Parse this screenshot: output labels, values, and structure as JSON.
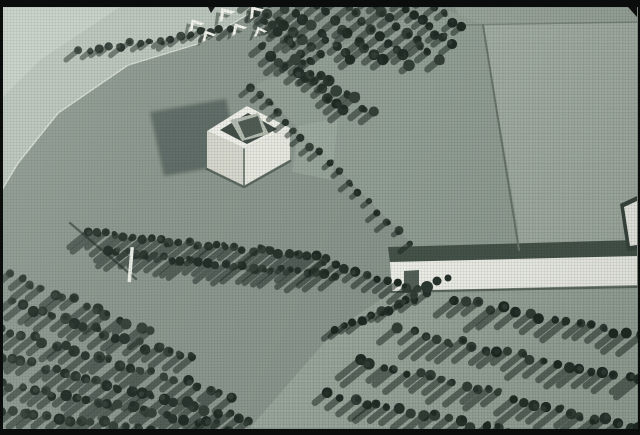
{
  "canvas": {
    "w": 640,
    "h": 435
  },
  "palette": {
    "lawn": "#8b978e",
    "light_wedge": "#bac5bb",
    "light_wedge_corner": "#cdd5ca",
    "plateau": "#a3aea4",
    "center_field": "#93a096",
    "south_field": "#9aa69c",
    "pale_patch": "#a4b0a5",
    "hedge_band": "#46544b",
    "white_structure": "#f2f3ec",
    "tree_dark_1": "#26322b",
    "tree_dark_2": "#323f37",
    "tree_dark_3": "#1f2a24",
    "tree_shadow": "rgba(22,34,27,0.5)",
    "film_border": "#0b0d0c"
  },
  "polygons": [
    {
      "name": "roadside-light-wedge",
      "points": [
        [
          0,
          7
        ],
        [
          258,
          7
        ],
        [
          200,
          42
        ],
        [
          128,
          64
        ],
        [
          58,
          112
        ],
        [
          18,
          162
        ],
        [
          0,
          192
        ]
      ],
      "fill": "#bac5bb"
    },
    {
      "name": "roadside-light-corner",
      "points": [
        [
          0,
          7
        ],
        [
          120,
          7
        ],
        [
          40,
          60
        ],
        [
          0,
          100
        ]
      ],
      "fill": "#cdd5ca",
      "opacity": 0.7
    },
    {
      "name": "upper-road-band",
      "points": [
        [
          455,
          7
        ],
        [
          637,
          7
        ],
        [
          637,
          23
        ],
        [
          462,
          25
        ]
      ],
      "fill": "#99a49a"
    },
    {
      "name": "gravel-plateau-field",
      "points": [
        [
          483,
          25
        ],
        [
          637,
          23
        ],
        [
          637,
          248
        ],
        [
          520,
          251
        ],
        [
          505,
          158
        ]
      ],
      "fill": "#a3aea4",
      "speckle": true
    },
    {
      "name": "center-meadow",
      "points": [
        [
          255,
          85
        ],
        [
          435,
          5
        ],
        [
          483,
          25
        ],
        [
          517,
          222
        ],
        [
          520,
          252
        ],
        [
          394,
          261
        ],
        [
          408,
          240
        ]
      ],
      "fill": "#93a096"
    },
    {
      "name": "pale-ground-patch",
      "points": [
        [
          298,
          126
        ],
        [
          338,
          118
        ],
        [
          332,
          180
        ],
        [
          292,
          172
        ]
      ],
      "fill": "#a4b0a5",
      "opacity": 0.55
    },
    {
      "name": "south-field",
      "points": [
        [
          392,
          292
        ],
        [
          637,
          286
        ],
        [
          637,
          428
        ],
        [
          250,
          428
        ],
        [
          335,
          330
        ]
      ],
      "fill": "#9aa69c",
      "speckle": true
    },
    {
      "name": "cube-cast-shadow",
      "points": [
        [
          150,
          112
        ],
        [
          226,
          99
        ],
        [
          240,
          163
        ],
        [
          164,
          176
        ]
      ],
      "fill": "rgba(28,42,34,0.40)",
      "blur": true
    },
    {
      "name": "hedge-band-behind-wall",
      "points": [
        [
          388,
          247
        ],
        [
          637,
          240
        ],
        [
          637,
          259
        ],
        [
          390,
          263
        ]
      ],
      "fill": "#46544b"
    },
    {
      "name": "long-white-wall",
      "points": [
        [
          390,
          262
        ],
        [
          637,
          256
        ],
        [
          637,
          285
        ],
        [
          392,
          291
        ]
      ],
      "fill": "#f2f3ec"
    },
    {
      "name": "wall-left-notch",
      "points": [
        [
          404,
          271
        ],
        [
          419,
          270
        ],
        [
          419,
          291
        ],
        [
          404,
          292
        ]
      ],
      "fill": "#55625a"
    },
    {
      "name": "edge-structure-frame",
      "points": [
        [
          620,
          204
        ],
        [
          637,
          196
        ],
        [
          637,
          250
        ],
        [
          627,
          251
        ]
      ],
      "fill": "#39453e"
    },
    {
      "name": "edge-structure-roof",
      "points": [
        [
          624,
          207
        ],
        [
          637,
          201
        ],
        [
          637,
          245
        ],
        [
          630,
          246
        ]
      ],
      "fill": "#eff0e9"
    },
    {
      "name": "cube-face-left",
      "points": [
        [
          207,
          131
        ],
        [
          244,
          148
        ],
        [
          244,
          186
        ],
        [
          207,
          168
        ]
      ],
      "fill": "#d8d9cf"
    },
    {
      "name": "cube-face-right",
      "points": [
        [
          244,
          148
        ],
        [
          290,
          128
        ],
        [
          290,
          160
        ],
        [
          244,
          186
        ]
      ],
      "fill": "#e9eae1"
    },
    {
      "name": "cube-roof-rim",
      "points": [
        [
          207,
          131
        ],
        [
          247,
          106
        ],
        [
          290,
          128
        ],
        [
          244,
          148
        ]
      ],
      "fill": "#f1f2ea"
    },
    {
      "name": "cube-courtyard-opening",
      "points": [
        [
          220,
          130
        ],
        [
          248,
          113
        ],
        [
          277,
          129
        ],
        [
          247,
          144
        ]
      ],
      "fill": "#3e4943"
    },
    {
      "name": "cube-inner-tilted-plane",
      "points": [
        [
          230,
          120
        ],
        [
          258,
          113
        ],
        [
          269,
          134
        ],
        [
          242,
          141
        ]
      ],
      "fill": "#b5bcb0"
    },
    {
      "name": "cube-inner-core",
      "points": [
        [
          238,
          122
        ],
        [
          258,
          116
        ],
        [
          263,
          132
        ],
        [
          245,
          138
        ]
      ],
      "fill": "#4d5850"
    },
    {
      "name": "film-notch-top",
      "points": [
        [
          208,
          7
        ],
        [
          215,
          7
        ],
        [
          211,
          13
        ]
      ],
      "fill": "#0d0f0e"
    },
    {
      "name": "film-notch-top-right",
      "points": [
        [
          628,
          7
        ],
        [
          637,
          7
        ],
        [
          637,
          17
        ]
      ],
      "fill": "#0d0f0e"
    }
  ],
  "polylines": [
    {
      "name": "path-edge-line",
      "points": [
        [
          258,
          8
        ],
        [
          200,
          43
        ],
        [
          128,
          65
        ],
        [
          58,
          113
        ],
        [
          18,
          163
        ],
        [
          0,
          193
        ]
      ],
      "stroke": "#d6ddd3",
      "width": 1.6
    },
    {
      "name": "cube-base-shadow",
      "points": [
        [
          207,
          169
        ],
        [
          244,
          187
        ],
        [
          290,
          161
        ]
      ],
      "stroke": "rgba(25,38,31,0.45)",
      "width": 2.5
    }
  ],
  "lines": [
    {
      "name": "plateau-top-edge",
      "x1": 458,
      "y1": 25,
      "x2": 637,
      "y2": 22,
      "stroke": "#7b867d",
      "width": 1.5
    },
    {
      "name": "plateau-left-edge",
      "x1": 483,
      "y1": 25,
      "x2": 519,
      "y2": 250,
      "stroke": "#6b766d",
      "width": 2
    },
    {
      "name": "pole-shadow-line",
      "x1": 70,
      "y1": 223,
      "x2": 136,
      "y2": 279,
      "stroke": "rgba(26,39,32,0.55)",
      "width": 2.4
    },
    {
      "name": "wall-bottom-shadow",
      "x1": 392,
      "y1": 292,
      "x2": 637,
      "y2": 287,
      "stroke": "rgba(30,42,35,0.5)",
      "width": 2
    },
    {
      "name": "cube-split-seam",
      "x1": 244,
      "y1": 149,
      "x2": 244,
      "y2": 185,
      "stroke": "#6f7a71",
      "width": 1.8
    }
  ],
  "trees": {
    "fills": [
      "#26322b",
      "#323f37",
      "#1f2a24"
    ],
    "shadow": "rgba(22,34,27,0.5)",
    "shadow_angle_deg": 141,
    "rows": [
      {
        "name": "roadside-row",
        "x1": 80,
        "y1": 52,
        "x2": 230,
        "y2": 28,
        "step": 10,
        "r": 3.5,
        "shLen": 12,
        "jitter": 2
      },
      {
        "name": "orchard-row-1",
        "x1": 252,
        "y1": 2,
        "x2": 320,
        "y2": 52,
        "step": 10,
        "r": 4.5,
        "shLen": 13,
        "jitter": 3
      },
      {
        "name": "orchard-row-2",
        "x1": 278,
        "y1": 0,
        "x2": 352,
        "y2": 58,
        "step": 10,
        "r": 4.5,
        "shLen": 13,
        "jitter": 3
      },
      {
        "name": "orchard-row-3",
        "x1": 308,
        "y1": 0,
        "x2": 382,
        "y2": 62,
        "step": 10,
        "r": 4.5,
        "shLen": 13,
        "jitter": 3
      },
      {
        "name": "orchard-row-4",
        "x1": 338,
        "y1": 0,
        "x2": 412,
        "y2": 64,
        "step": 10,
        "r": 4.5,
        "shLen": 13,
        "jitter": 3
      },
      {
        "name": "orchard-row-5",
        "x1": 368,
        "y1": 0,
        "x2": 438,
        "y2": 58,
        "step": 10,
        "r": 4.5,
        "shLen": 13,
        "jitter": 3
      },
      {
        "name": "orchard-row-6",
        "x1": 398,
        "y1": 0,
        "x2": 452,
        "y2": 46,
        "step": 10,
        "r": 4.0,
        "shLen": 12,
        "jitter": 3
      },
      {
        "name": "orchard-row-7",
        "x1": 425,
        "y1": 0,
        "x2": 460,
        "y2": 28,
        "step": 9,
        "r": 4.0,
        "shLen": 11,
        "jitter": 2
      },
      {
        "name": "orchard-row-8",
        "x1": 255,
        "y1": 12,
        "x2": 310,
        "y2": 58,
        "step": 10,
        "r": 4.5,
        "shLen": 13,
        "jitter": 3
      },
      {
        "name": "orchard-row-9",
        "x1": 262,
        "y1": 48,
        "x2": 346,
        "y2": 108,
        "step": 10,
        "r": 4.5,
        "shLen": 13,
        "jitter": 3
      },
      {
        "name": "orchard-row-10",
        "x1": 296,
        "y1": 60,
        "x2": 372,
        "y2": 112,
        "step": 10,
        "r": 4.5,
        "shLen": 13,
        "jitter": 3
      },
      {
        "name": "allee-file-upper",
        "x1": 252,
        "y1": 86,
        "x2": 310,
        "y2": 148,
        "step": 12,
        "r": 3.5,
        "shLen": 10,
        "jitter": 2
      },
      {
        "name": "allee-file-lower",
        "x1": 318,
        "y1": 152,
        "x2": 408,
        "y2": 242,
        "step": 13,
        "r": 3.5,
        "shLen": 10,
        "jitter": 2
      },
      {
        "name": "mid-belt-row-1",
        "x1": 88,
        "y1": 232,
        "x2": 325,
        "y2": 258,
        "step": 9,
        "r": 4.0,
        "shLen": 24,
        "jitter": 2
      },
      {
        "name": "mid-belt-row-2",
        "x1": 108,
        "y1": 252,
        "x2": 335,
        "y2": 276,
        "step": 9,
        "r": 4.0,
        "shLen": 22,
        "jitter": 2
      },
      {
        "name": "mid-belt-row-3",
        "x1": 325,
        "y1": 262,
        "x2": 418,
        "y2": 290,
        "step": 10,
        "r": 4.0,
        "shLen": 18,
        "jitter": 2
      },
      {
        "name": "wall-hedge-row",
        "x1": 336,
        "y1": 330,
        "x2": 425,
        "y2": 295,
        "step": 9,
        "r": 4.0,
        "shLen": 14,
        "jitter": 2
      },
      {
        "name": "grove-row-1",
        "x1": 0,
        "y1": 272,
        "x2": 150,
        "y2": 330,
        "step": 11,
        "r": 4.5,
        "shLen": 20,
        "jitter": 3
      },
      {
        "name": "grove-row-2",
        "x1": 0,
        "y1": 300,
        "x2": 190,
        "y2": 360,
        "step": 11,
        "r": 4.5,
        "shLen": 20,
        "jitter": 3
      },
      {
        "name": "grove-row-3",
        "x1": 0,
        "y1": 328,
        "x2": 230,
        "y2": 395,
        "step": 11,
        "r": 4.5,
        "shLen": 20,
        "jitter": 3
      },
      {
        "name": "grove-row-4",
        "x1": 0,
        "y1": 356,
        "x2": 250,
        "y2": 420,
        "step": 11,
        "r": 4.5,
        "shLen": 20,
        "jitter": 3
      },
      {
        "name": "grove-row-5",
        "x1": 0,
        "y1": 384,
        "x2": 230,
        "y2": 428,
        "step": 11,
        "r": 4.5,
        "shLen": 20,
        "jitter": 3
      },
      {
        "name": "grove-row-6",
        "x1": 0,
        "y1": 412,
        "x2": 150,
        "y2": 428,
        "step": 11,
        "r": 4.5,
        "shLen": 18,
        "jitter": 3
      },
      {
        "name": "se-row-1",
        "x1": 455,
        "y1": 300,
        "x2": 640,
        "y2": 336,
        "step": 12,
        "r": 4.5,
        "shLen": 26,
        "jitter": 3
      },
      {
        "name": "se-row-2",
        "x1": 400,
        "y1": 330,
        "x2": 640,
        "y2": 382,
        "step": 12,
        "r": 4.5,
        "shLen": 26,
        "jitter": 3
      },
      {
        "name": "se-row-3",
        "x1": 360,
        "y1": 360,
        "x2": 640,
        "y2": 430,
        "step": 12,
        "r": 4.5,
        "shLen": 26,
        "jitter": 3
      },
      {
        "name": "se-row-4",
        "x1": 330,
        "y1": 395,
        "x2": 520,
        "y2": 435,
        "step": 12,
        "r": 4.5,
        "shLen": 22,
        "jitter": 3
      }
    ]
  },
  "houses": {
    "shape": "M -8,5 L 0,-4 L 8,5 L 4.5,5 L 0,0 L -4.5,5 Z",
    "fill": "#f4f5ee",
    "shadow_fill": "rgba(25,38,31,0.45)",
    "shadow_dx": -5,
    "shadow_dy": 4,
    "items": [
      {
        "x": 194,
        "y": 23,
        "rot": -30,
        "s": 1.1
      },
      {
        "x": 207,
        "y": 34,
        "rot": -28,
        "s": 1.0
      },
      {
        "x": 224,
        "y": 12,
        "rot": -35,
        "s": 1.2
      },
      {
        "x": 237,
        "y": 27,
        "rot": -30,
        "s": 1.1
      },
      {
        "x": 254,
        "y": 10,
        "rot": -35,
        "s": 1.1
      },
      {
        "x": 259,
        "y": 30,
        "rot": -22,
        "s": 0.9
      }
    ]
  },
  "circles": [
    {
      "name": "wall-front-tree-1",
      "cx": 427,
      "cy": 287,
      "r": 6,
      "fill": "#2c3832"
    },
    {
      "name": "wall-front-tree-2",
      "cx": 437,
      "cy": 281,
      "r": 4.5,
      "fill": "#26322b"
    },
    {
      "name": "wall-front-tree-3",
      "cx": 414,
      "cy": 295,
      "r": 4,
      "fill": "#323f37"
    },
    {
      "name": "wall-front-tree-4",
      "cx": 448,
      "cy": 278,
      "r": 3.5,
      "fill": "#26322b"
    }
  ],
  "pole": {
    "x": 130.5,
    "y": 247,
    "w": 3.5,
    "h": 35,
    "rot": 5,
    "fill": "#eef1e9"
  }
}
